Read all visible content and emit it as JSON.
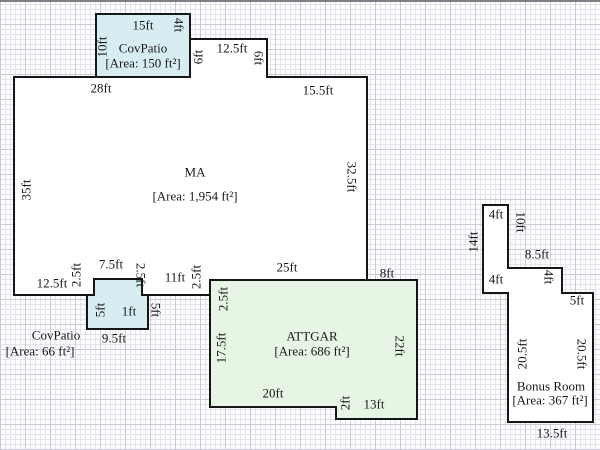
{
  "colors": {
    "paper": "#fdfdfe",
    "grid_minor": "#e4e4ee",
    "grid_major": "#cbcbd8",
    "wall": "#161616",
    "text": "#181818",
    "fill_patio": "#d7edf2",
    "fill_garage": "#e7f6e4",
    "fill_living": "#ffffff"
  },
  "rooms": [
    {
      "id": "ma",
      "fill_key": "fill_living",
      "points": "14,75 190,75 190,37 267,37 267,75 367,75 367,278 211,278 211,293 142,293 142,277 94,277 94,293 14,293"
    },
    {
      "id": "covpatio-top",
      "fill_key": "fill_patio",
      "points": "96,12 190,12 190,75 96,75"
    },
    {
      "id": "covpatio-bottom",
      "fill_key": "fill_patio",
      "points": "94,277 142,277 142,293 148,293 148,327 87,327 87,293 94,293"
    },
    {
      "id": "attgar",
      "fill_key": "fill_garage",
      "points": "210,278 417,278 417,417 336,417 336,405 210,405"
    },
    {
      "id": "bonus-room",
      "fill_key": "fill_living",
      "points": "483,203 508,203 508,266 562,266 562,291 593,291 593,420 508,420 508,291 483,291"
    }
  ],
  "labels": [
    {
      "name": "dim-covpatio-top-15ft",
      "text": "15ft",
      "x": 143,
      "y": 23,
      "rot": 0
    },
    {
      "name": "dim-covpatio-right-4ft",
      "text": "4ft",
      "x": 179,
      "y": 23,
      "rot": 90
    },
    {
      "name": "dim-covpatio-left-10ft",
      "text": "10ft",
      "x": 102,
      "y": 45,
      "rot": -90
    },
    {
      "name": "covpatio-top-name",
      "text": "CovPatio",
      "x": 143,
      "y": 46,
      "rot": 0
    },
    {
      "name": "covpatio-top-area",
      "text": "[Area: 150 ft²]",
      "x": 143,
      "y": 61,
      "rot": 0
    },
    {
      "name": "dim-bump-left-6ft",
      "text": "6ft",
      "x": 198,
      "y": 55,
      "rot": -90
    },
    {
      "name": "dim-bump-12-5ft",
      "text": "12.5ft",
      "x": 232,
      "y": 46,
      "rot": 0
    },
    {
      "name": "dim-bump-right-6ft",
      "text": "6ft",
      "x": 259,
      "y": 56,
      "rot": 90
    },
    {
      "name": "dim-ma-28ft",
      "text": "28ft",
      "x": 101,
      "y": 86,
      "rot": 0
    },
    {
      "name": "dim-ma-15-5ft",
      "text": "15.5ft",
      "x": 318,
      "y": 88,
      "rot": 0
    },
    {
      "name": "dim-ma-35ft",
      "text": "35ft",
      "x": 26,
      "y": 188,
      "rot": -90
    },
    {
      "name": "ma-name",
      "text": "MA",
      "x": 195,
      "y": 170,
      "rot": 0
    },
    {
      "name": "ma-area",
      "text": "[Area: 1,954 ft²]",
      "x": 195,
      "y": 194,
      "rot": 0
    },
    {
      "name": "dim-ma-32-5ft",
      "text": "32.5ft",
      "x": 352,
      "y": 175,
      "rot": 90
    },
    {
      "name": "dim-ma-12-5ft-bottom",
      "text": "12.5ft",
      "x": 52,
      "y": 281,
      "rot": 0
    },
    {
      "name": "dim-notch-left-2-5ft",
      "text": "2.5ft",
      "x": 76,
      "y": 273,
      "rot": -90
    },
    {
      "name": "dim-notch-7-5ft",
      "text": "7.5ft",
      "x": 111,
      "y": 262,
      "rot": 0
    },
    {
      "name": "dim-notch-right-2-5ft",
      "text": "2.5ft",
      "x": 141,
      "y": 273,
      "rot": 90
    },
    {
      "name": "dim-ma-11ft",
      "text": "11ft",
      "x": 175,
      "y": 275,
      "rot": 0
    },
    {
      "name": "dim-ma-step-2-5ft",
      "text": "2.5ft",
      "x": 196,
      "y": 275,
      "rot": -90
    },
    {
      "name": "dim-covpatio2-left-5ft",
      "text": "5ft",
      "x": 100,
      "y": 308,
      "rot": -90
    },
    {
      "name": "dim-covpatio2-1ft",
      "text": "1ft",
      "x": 129,
      "y": 309,
      "rot": 0
    },
    {
      "name": "dim-covpatio2-right-5ft",
      "text": "5ft",
      "x": 156,
      "y": 308,
      "rot": 90
    },
    {
      "name": "dim-covpatio2-9-5ft",
      "text": "9.5ft",
      "x": 114,
      "y": 336,
      "rot": 0
    },
    {
      "name": "covpatio2-name",
      "text": "CovPatio",
      "x": 56,
      "y": 333,
      "rot": 0
    },
    {
      "name": "covpatio2-area",
      "text": "[Area: 66 ft²]",
      "x": 40,
      "y": 349,
      "rot": 0
    },
    {
      "name": "dim-attgar-25ft",
      "text": "25ft",
      "x": 287,
      "y": 265,
      "rot": 0
    },
    {
      "name": "dim-attgar-8ft",
      "text": "8ft",
      "x": 387,
      "y": 271,
      "rot": 0
    },
    {
      "name": "dim-attgar-2-5ft",
      "text": "2.5ft",
      "x": 223,
      "y": 297,
      "rot": -90
    },
    {
      "name": "dim-attgar-17-5ft",
      "text": "17.5ft",
      "x": 221,
      "y": 346,
      "rot": -90
    },
    {
      "name": "attgar-name",
      "text": "ATTGAR",
      "x": 312,
      "y": 334,
      "rot": 0
    },
    {
      "name": "attgar-area",
      "text": "[Area: 686 ft²]",
      "x": 312,
      "y": 349,
      "rot": 0
    },
    {
      "name": "dim-attgar-22ft",
      "text": "22ft",
      "x": 400,
      "y": 344,
      "rot": 90
    },
    {
      "name": "dim-attgar-20ft",
      "text": "20ft",
      "x": 273,
      "y": 391,
      "rot": 0
    },
    {
      "name": "dim-attgar-2ft",
      "text": "2ft",
      "x": 345,
      "y": 401,
      "rot": -90
    },
    {
      "name": "dim-attgar-13ft",
      "text": "13ft",
      "x": 374,
      "y": 402,
      "rot": 0
    },
    {
      "name": "dim-bonus-4ft-top",
      "text": "4ft",
      "x": 496,
      "y": 212,
      "rot": 0
    },
    {
      "name": "dim-bonus-10ft",
      "text": "10ft",
      "x": 521,
      "y": 220,
      "rot": 90
    },
    {
      "name": "dim-bonus-14ft",
      "text": "14ft",
      "x": 473,
      "y": 240,
      "rot": -90
    },
    {
      "name": "dim-bonus-8-5ft",
      "text": "8.5ft",
      "x": 537,
      "y": 252,
      "rot": 0
    },
    {
      "name": "dim-bonus-4ft-mid",
      "text": "4ft",
      "x": 549,
      "y": 275,
      "rot": 90
    },
    {
      "name": "dim-bonus-4ft-left",
      "text": "4ft",
      "x": 496,
      "y": 277,
      "rot": 0
    },
    {
      "name": "dim-bonus-5ft",
      "text": "5ft",
      "x": 577,
      "y": 298,
      "rot": 0
    },
    {
      "name": "dim-bonus-20-5ft-left",
      "text": "20.5ft",
      "x": 522,
      "y": 352,
      "rot": -90
    },
    {
      "name": "dim-bonus-20-5ft-right",
      "text": "20.5ft",
      "x": 582,
      "y": 352,
      "rot": 90
    },
    {
      "name": "bonus-name",
      "text": "Bonus Room",
      "x": 551,
      "y": 384,
      "rot": 0
    },
    {
      "name": "bonus-area",
      "text": "[Area: 367 ft²]",
      "x": 550,
      "y": 398,
      "rot": 0
    },
    {
      "name": "dim-bonus-13-5ft",
      "text": "13.5ft",
      "x": 552,
      "y": 431,
      "rot": 0
    }
  ]
}
